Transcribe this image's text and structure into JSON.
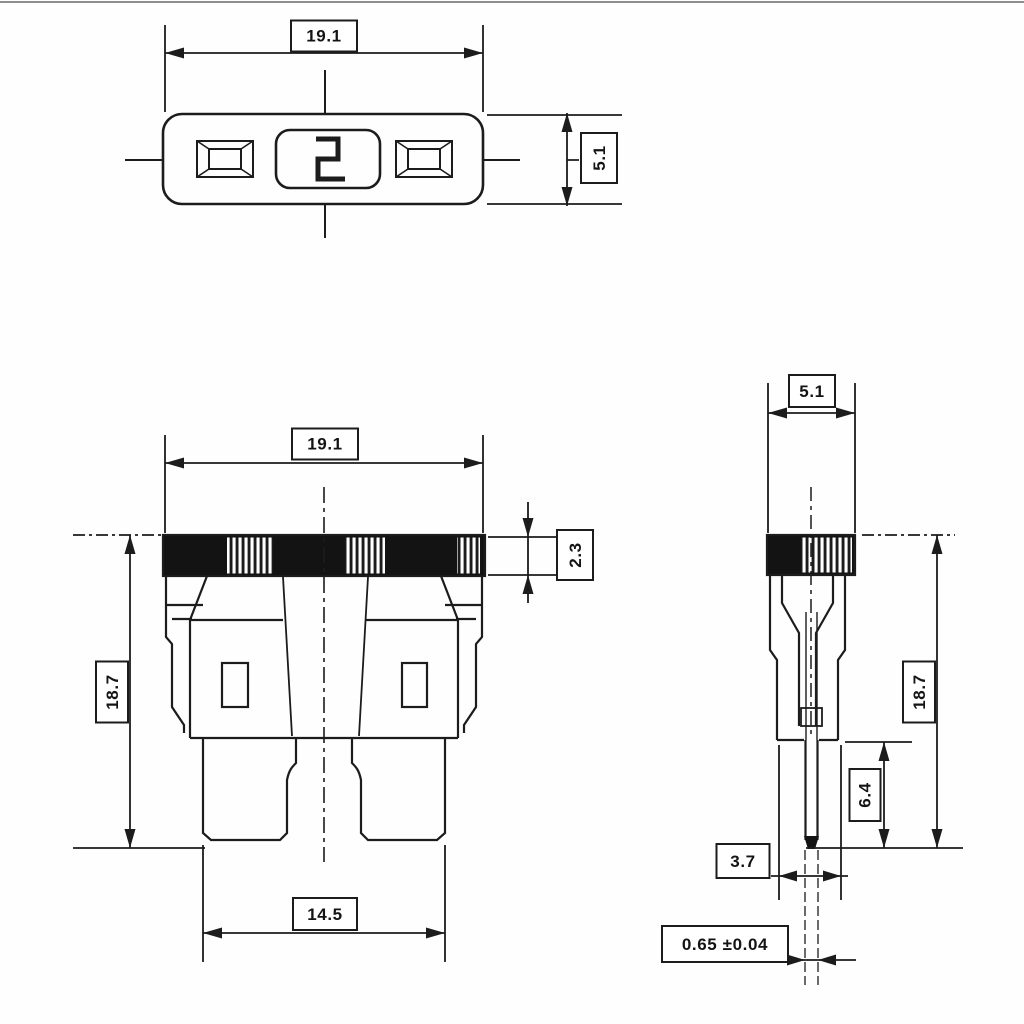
{
  "colors": {
    "line": "#1c1c1c",
    "background": "#fefefe",
    "cap_fill": "#131313"
  },
  "views": {
    "top": {
      "width": "19.1",
      "height": "5.1",
      "marking": "2"
    },
    "front": {
      "width": "19.1",
      "height": "18.7",
      "cap_height": "2.3",
      "terminal_span": "14.5"
    },
    "side": {
      "width": "5.1",
      "height": "18.7",
      "terminal_length": "6.4",
      "body_depth": "3.7",
      "terminal_thickness": "0.65 ±0.04"
    }
  }
}
